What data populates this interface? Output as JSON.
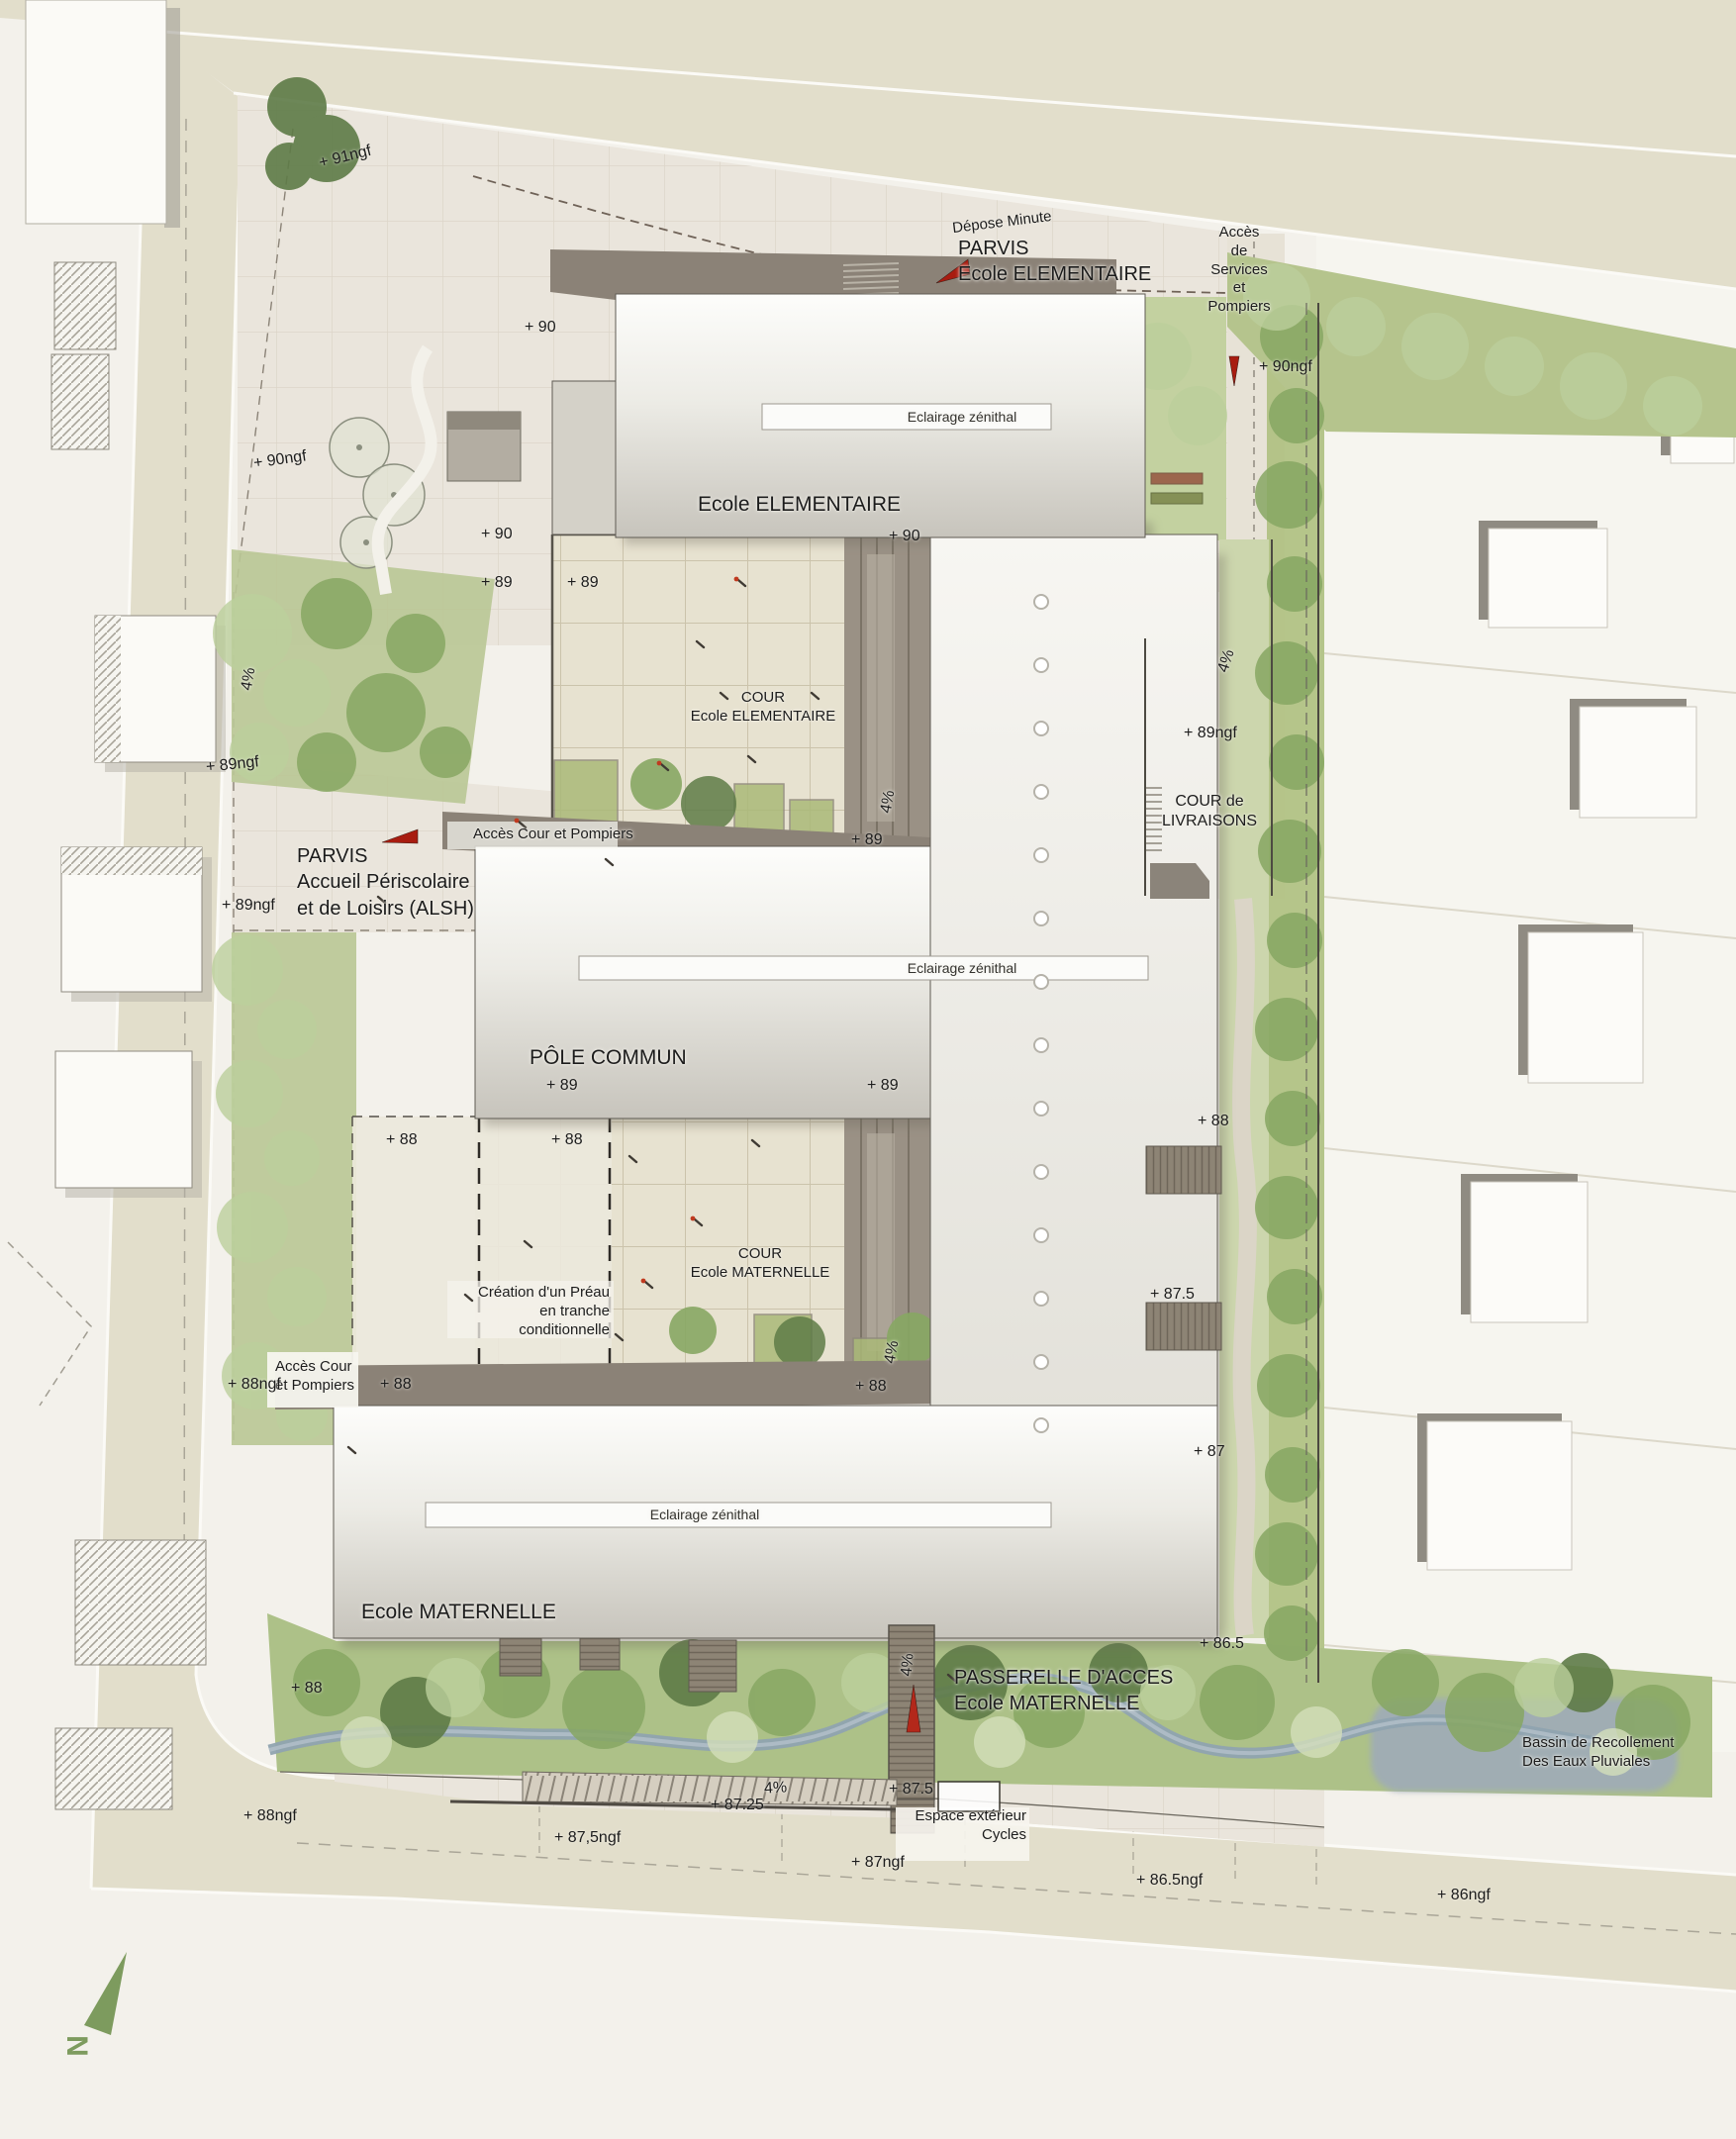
{
  "labels": {
    "depose_minute": "Dépose Minute",
    "parvis_elementaire": "PARVIS\nEcole ELEMENTAIRE",
    "acces_services": "Accès\nde\nServices\net\nPompiers",
    "ecole_elementaire": "Ecole ELEMENTAIRE",
    "eclairage_zenithal": "Eclairage zénithal",
    "cour_elementaire": "COUR\nEcole ELEMENTAIRE",
    "cour_livraisons": "COUR de\nLIVRAISONS",
    "acces_cour_pompiers": "Accès Cour et Pompiers",
    "parvis_alsh": "PARVIS\nAccueil Périscolaire\net de Loisirs (ALSH)",
    "pole_commun": "PÔLE COMMUN",
    "cour_maternelle": "COUR\nEcole MATERNELLE",
    "creation_preau": "Création d'un Préau\nen tranche\nconditionnelle",
    "acces_cour_pompiers_2": "Accès Cour\net Pompiers",
    "ecole_maternelle": "Ecole MATERNELLE",
    "passerelle": "PASSERELLE D'ACCES\nEcole MATERNELLE",
    "bassin": "Bassin de Recollement\nDes Eaux Pluviales",
    "espace_cycles": "Espace extérieur\nCycles",
    "slope_4pct": "4%",
    "north": "N"
  },
  "elev": {
    "ngf91": "+ 91ngf",
    "ngf90": "+ 90ngf",
    "ngf89": "+ 89ngf",
    "ngf88": "+ 88ngf",
    "ngf875": "+ 87,5ngf",
    "ngf87": "+ 87ngf",
    "ngf865": "+ 86.5ngf",
    "ngf86": "+ 86ngf",
    "p90": "+ 90",
    "p89": "+ 89",
    "p88": "+ 88",
    "p875": "+ 87.5",
    "p8725": "+ 87.25",
    "p87": "+ 87",
    "p865": "+ 86.5"
  },
  "colors": {
    "accent_red": "#a81c10",
    "north_green": "#7d9b5e",
    "water": "#9fabb8",
    "building_grey": "#c7c4bc",
    "landscape_green": "#a9bd85",
    "road_beige": "#e2decb"
  }
}
